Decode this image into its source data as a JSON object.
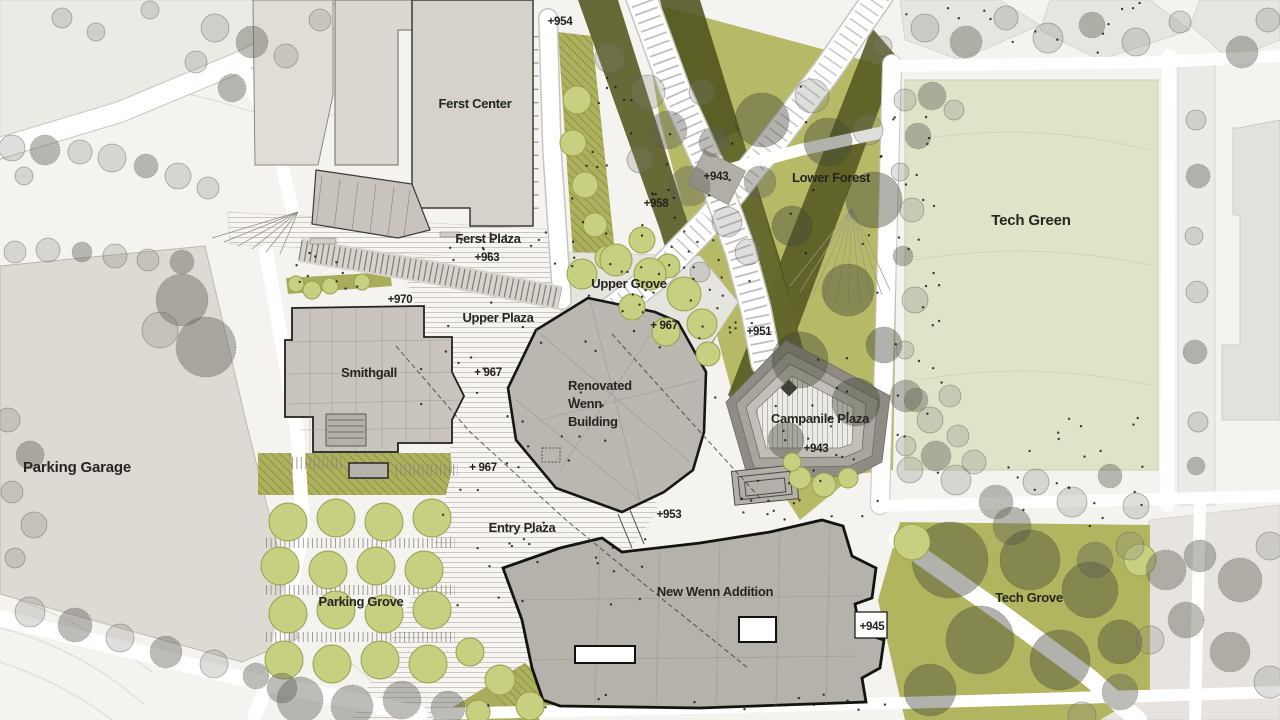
{
  "map": {
    "places": {
      "ferst_center": "Ferst Center",
      "ferst_plaza": "Ferst Plaza",
      "upper_grove": "Upper Grove",
      "upper_plaza": "Upper Plaza",
      "lower_forest": "Lower Forest",
      "tech_green": "Tech Green",
      "smithgall": "Smithgall",
      "renovated_wenn": {
        "line1": "Renovated",
        "line2": "Wenn",
        "line3": "Building"
      },
      "campanile_plaza": "Campanile Plaza",
      "parking_garage": "Parking Garage",
      "entry_plaza": "Entry Plaza",
      "parking_grove": "Parking Grove",
      "new_wenn_addition": "New Wenn Addition",
      "tech_grove": "Tech Grove"
    },
    "elevations": {
      "e954": "+954",
      "e943_upper": "+943",
      "e958": "+958",
      "e963": "+963",
      "e970": "+970",
      "e951": "+951",
      "e967_grove": "+ 967",
      "e967_plaza": "+ 967",
      "e967_entry": "+ 967",
      "e943_campanile": "+943",
      "e953": "+953",
      "e945": "+945"
    },
    "palette": {
      "background": "#f4f3f0",
      "lawn_green": "#dfe4c9",
      "planting_olive": "#b1b560",
      "forest_dark_olive": "#565a24",
      "building_existing": "#d6d2cb",
      "building_new": "#b5b1ab",
      "path_white": "#ffffff",
      "label_ink": "#262520"
    }
  }
}
